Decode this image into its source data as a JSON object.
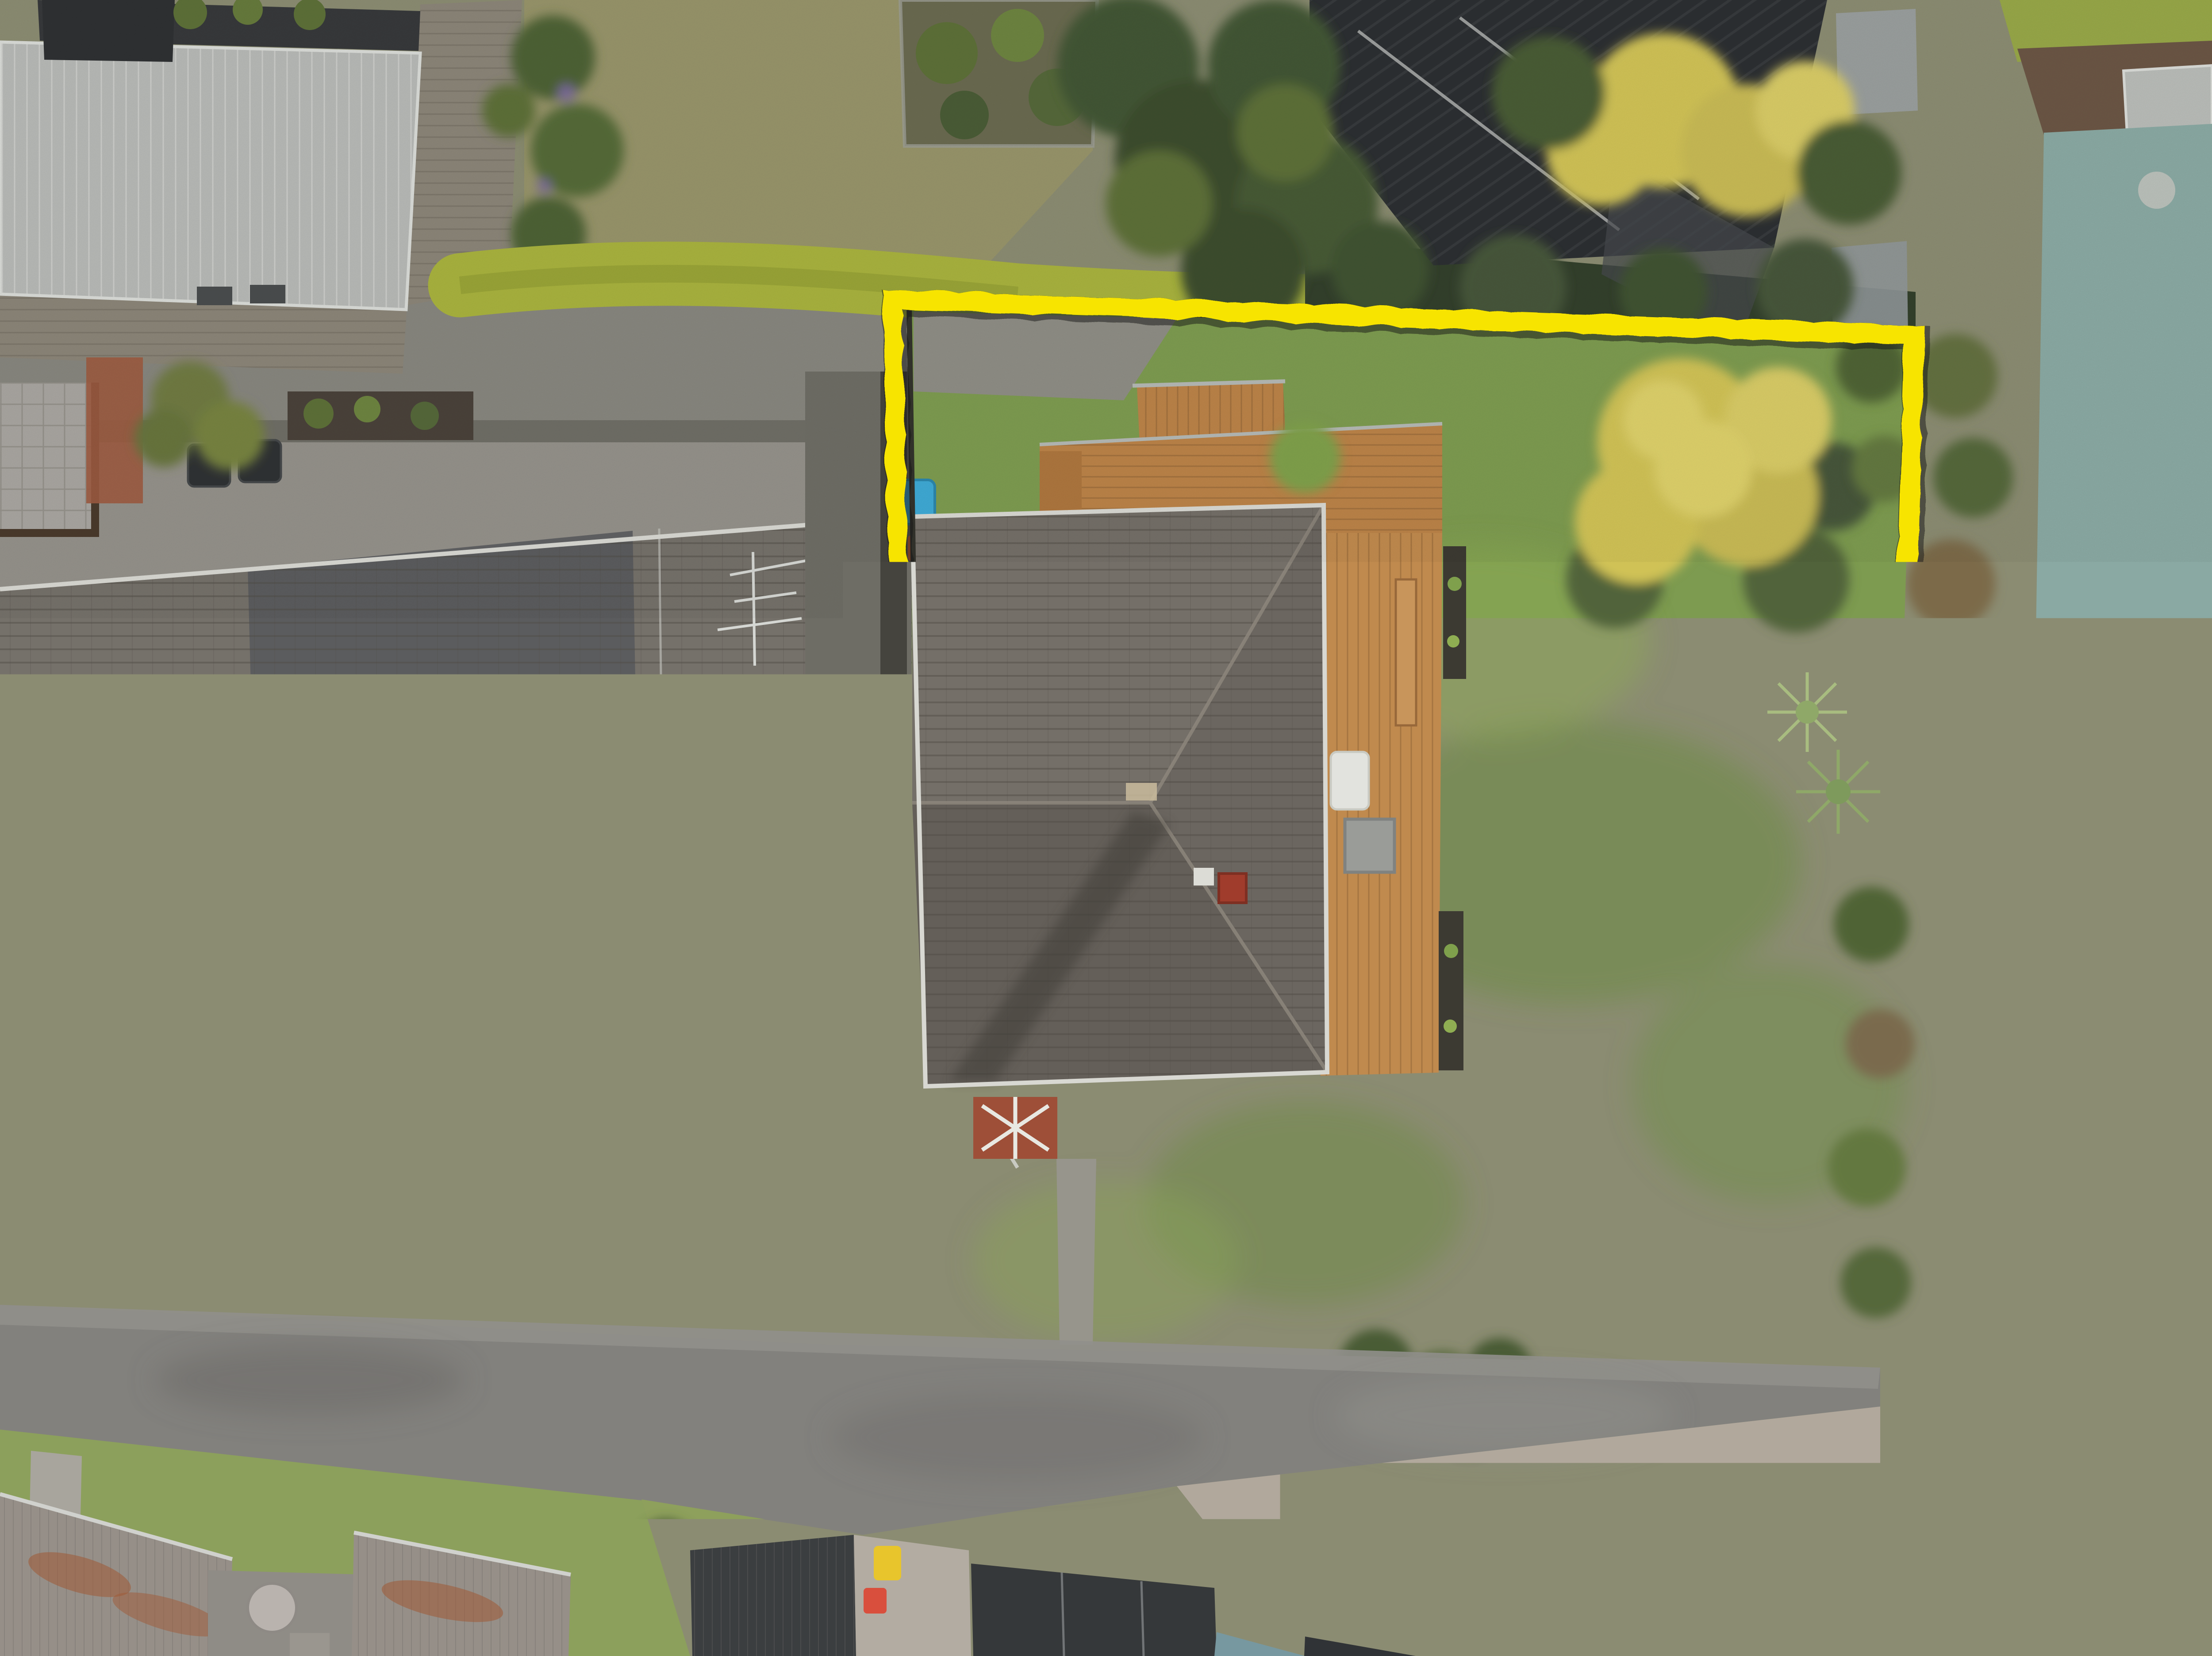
{
  "scene": {
    "type": "aerial-drone-photo",
    "description": "Top-down aerial photograph of suburban residential properties. A thick hand-drawn yellow rectangle outlines the subject property: a dark grey hip-roof house with a timber deck, bright green back lawn, golden tree, vegetable garden beds. Neighbouring lots show a long duplex tile roof at left, a black modern roof and pool at top right, an asphalt driveway across the bottom, rusty corrugated roofs bottom-left and a red tile roof house bottom-right.",
    "boundary": {
      "color": "#f7e400",
      "stroke_width": 44,
      "corners": [
        [
          2012,
          672
        ],
        [
          4322,
          752
        ],
        [
          4252,
          3094
        ],
        [
          2062,
          3028
        ]
      ]
    },
    "objects": [
      "property-boundary-overlay",
      "subject-house-roof",
      "chimney",
      "satellite-dish",
      "wood-deck",
      "deck-stairs",
      "deck-bench",
      "outdoor-table",
      "heat-pump-unit",
      "back-lawn",
      "concrete-pad",
      "kiddie-pool",
      "clothesline",
      "garden-path",
      "vegetable-garden-beds",
      "golden-tree",
      "cabbage-tree",
      "boundary-hedge",
      "neighbor-duplex-roof",
      "tv-antenna",
      "conservatory-roof",
      "shade-sail",
      "paver-patio",
      "wheelie-bins",
      "metal-roof-house",
      "deck-walkway",
      "dry-lawn",
      "fenced-garden-patch",
      "black-roof-house",
      "pergola-panels",
      "swimming-pool",
      "spa-tub",
      "mulch-garden",
      "trampoline",
      "shrub-fence-line",
      "asphalt-driveway",
      "concrete-apron",
      "rusty-roof",
      "courtyard-table",
      "dark-corrugated-roofs",
      "yellow-rooftop-object",
      "red-rooftop-object",
      "red-tile-roof-house",
      "white-pergola-deck"
    ]
  },
  "palette": {
    "boundary_yellow": "#f7e400",
    "lawn_bright": "#7d9b50",
    "lawn_dry": "#97946a",
    "lawn_left": "#8ca05c",
    "asphalt": "#82817d",
    "concrete_light": "#b1a89c",
    "roof_dark_tile": "#6f6b64",
    "roof_left_tile": "#75716a",
    "roof_black": "#2c2f32",
    "roof_light_metal": "#b7b9b6",
    "roof_red": "#a2544a",
    "roof_rust_base": "#968f88",
    "deck_wood": "#bb8348",
    "deck_gray": "#8b8578",
    "hedge_green": "#a8b23e",
    "tree_green_dark": "#435634",
    "tree_yellow": "#d0c257",
    "pool_teal": "#8aa9a3",
    "mulch_brown": "#6b5645",
    "glass_roof": "#b9b7b4",
    "shade_sail": "#3a3d40",
    "spa_blue": "#44586c",
    "brick_red": "#9e4f38",
    "toy_blue": "#3fa9d4",
    "toy_orange": "#d86a38",
    "object_yellow": "#e8c52c",
    "object_red": "#d94f3d",
    "white_trim": "#e2e3de"
  }
}
